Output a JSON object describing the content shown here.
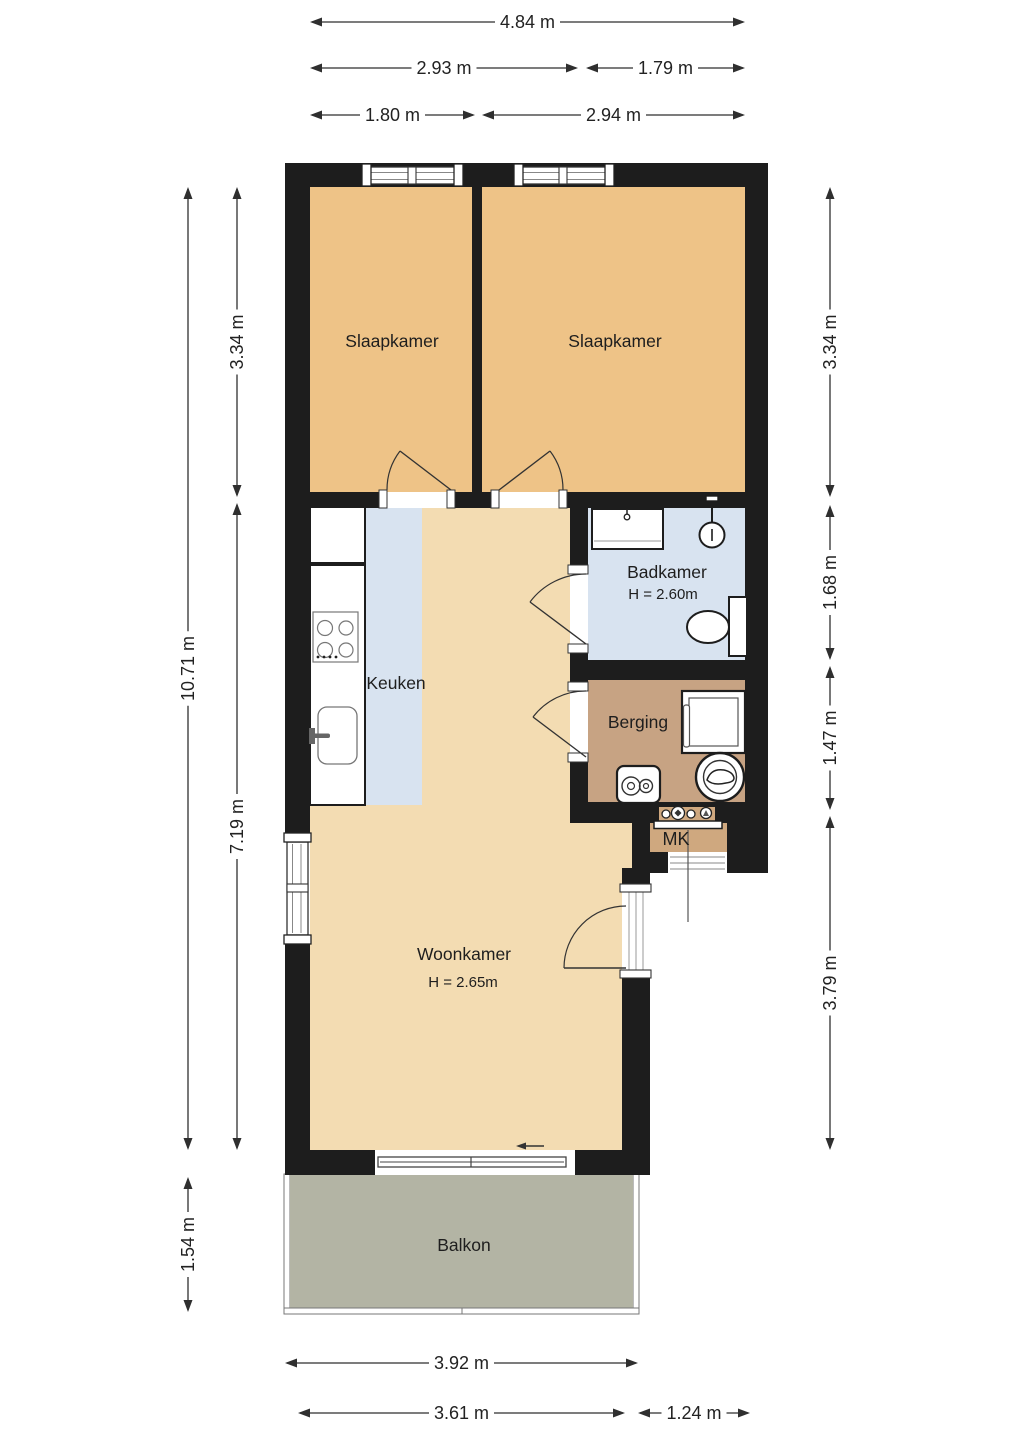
{
  "title": "Apartment floor plan",
  "rooms": {
    "slaapkamer1": {
      "label": "Slaapkamer"
    },
    "slaapkamer2": {
      "label": "Slaapkamer"
    },
    "badkamer": {
      "label": "Badkamer",
      "height": "H = 2.60m"
    },
    "keuken": {
      "label": "Keuken"
    },
    "berging": {
      "label": "Berging"
    },
    "mk": {
      "label": "MK"
    },
    "woonkamer": {
      "label": "Woonkamer",
      "height": "H = 2.65m"
    },
    "balkon": {
      "label": "Balkon"
    }
  },
  "dimensions": {
    "top": [
      "4.84 m",
      "2.93 m",
      "1.79 m",
      "1.80 m",
      "2.94 m"
    ],
    "left": [
      "3.34 m",
      "10.71 m",
      "7.19 m",
      "1.54 m"
    ],
    "right": [
      "3.34 m",
      "1.68 m",
      "1.47 m",
      "3.79 m"
    ],
    "bottom": [
      "3.92 m",
      "3.61 m",
      "1.24 m"
    ]
  },
  "colors": {
    "wall": "#1d1d1d",
    "bedroom_floor": "#eec387",
    "living_floor": "#f3dcb2",
    "storage_floor": "#c7a383",
    "mk_floor": "#cfa87f",
    "wet_floor": "#d8e3f0",
    "balcony_floor": "#b3b4a4",
    "dimension_text": "#222222"
  }
}
